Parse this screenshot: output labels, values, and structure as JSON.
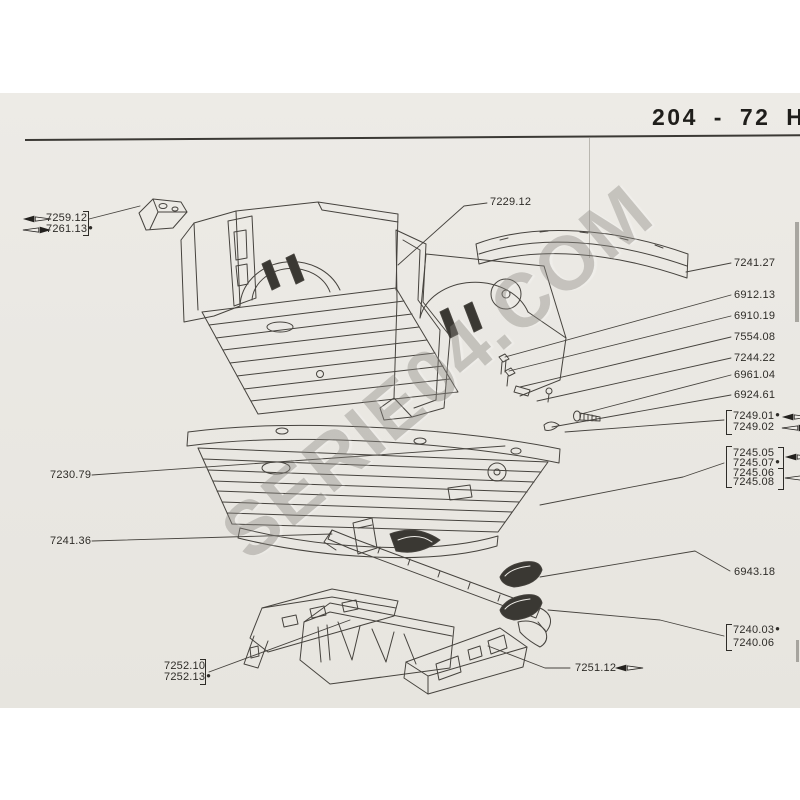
{
  "header": {
    "title": "204 - 72 H"
  },
  "watermark": {
    "text": "SERIE04.COM"
  },
  "markers": {
    "dot": "●"
  },
  "icons": {
    "direction_left": "left-direction-arrow ◄",
    "direction_right": "right-direction-arrow ►"
  },
  "colors": {
    "paper": "#eae8e3",
    "ink": "#2e2c28",
    "drawing_line": "#46433e",
    "watermark": "#8d8a84",
    "dark_fill": "#3a3833"
  },
  "parts": {
    "p7259_12": "7259.12",
    "p7261_13": "7261.13",
    "p7229_12": "7229.12",
    "p7241_27": "7241.27",
    "p6912_13": "6912.13",
    "p6910_19": "6910.19",
    "p7554_08": "7554.08",
    "p7244_22": "7244.22",
    "p6961_04": "6961.04",
    "p6924_61": "6924.61",
    "p7249_01": "7249.01",
    "p7249_02": "7249.02",
    "p7245_05": "7245.05",
    "p7245_07": "7245.07",
    "p7245_06": "7245.06",
    "p7245_08": "7245.08",
    "p6943_18": "6943.18",
    "p7240_03": "7240.03",
    "p7240_06": "7240.06",
    "p7251_12": "7251.12",
    "p7230_79": "7230.79",
    "p7241_36": "7241.36",
    "p7252_10": "7252.10",
    "p7252_13": "7252.13"
  }
}
